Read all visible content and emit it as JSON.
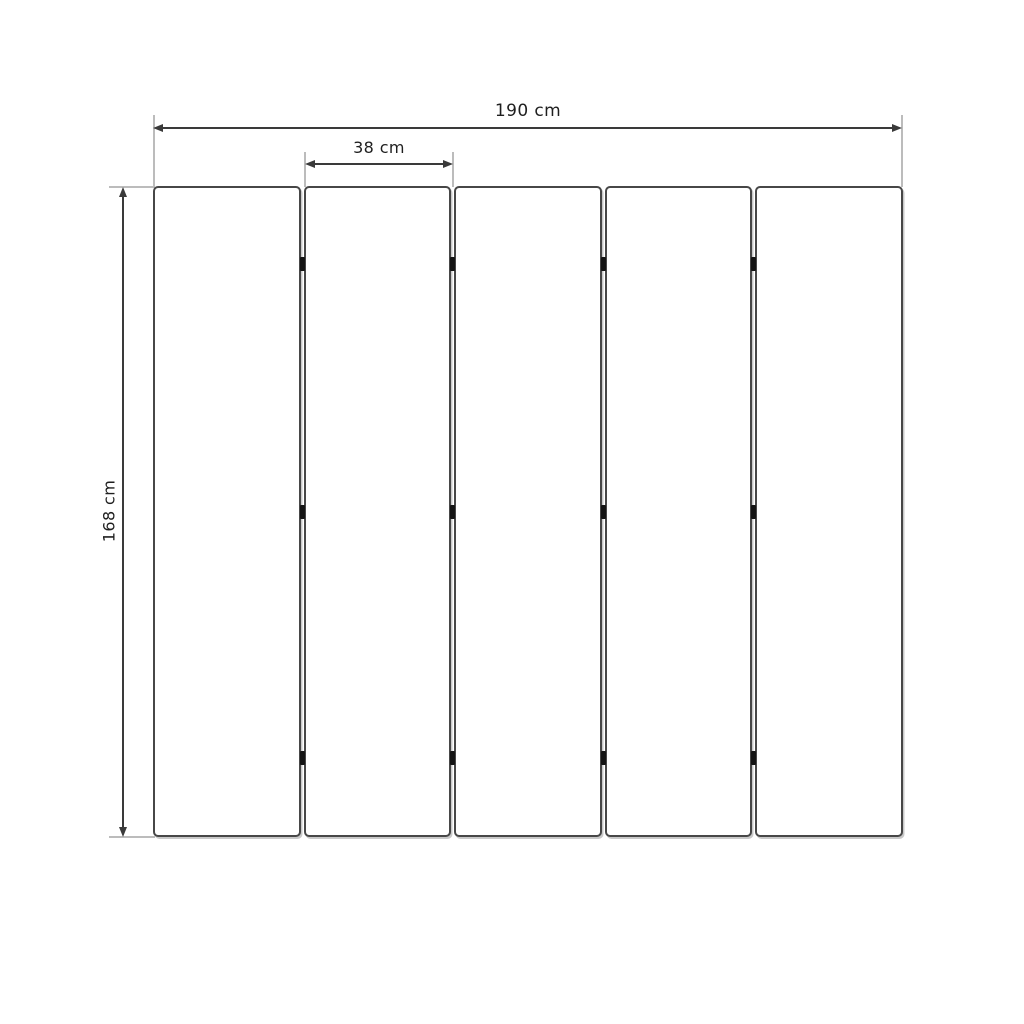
{
  "diagram": {
    "type": "folding-screen-dimension-drawing",
    "panel_count": 5,
    "hinge_gaps": 4,
    "hinges_per_gap": 3,
    "hinge_row_fractions": [
      0.12,
      0.5,
      0.878
    ],
    "labels": {
      "total_width": "190 cm",
      "panel_width": "38 cm",
      "height": "168 cm"
    },
    "values": {
      "total_width_cm": 190,
      "panel_width_cm": 38,
      "height_cm": 168
    },
    "colors": {
      "background": "#ffffff",
      "dimension_line": "#3a3a3a",
      "extension_line": "#bcbcbc",
      "panel_border": "#474747",
      "panel_fill": "#ffffff",
      "hinge": "#141414",
      "text": "#1f1f1f"
    }
  }
}
